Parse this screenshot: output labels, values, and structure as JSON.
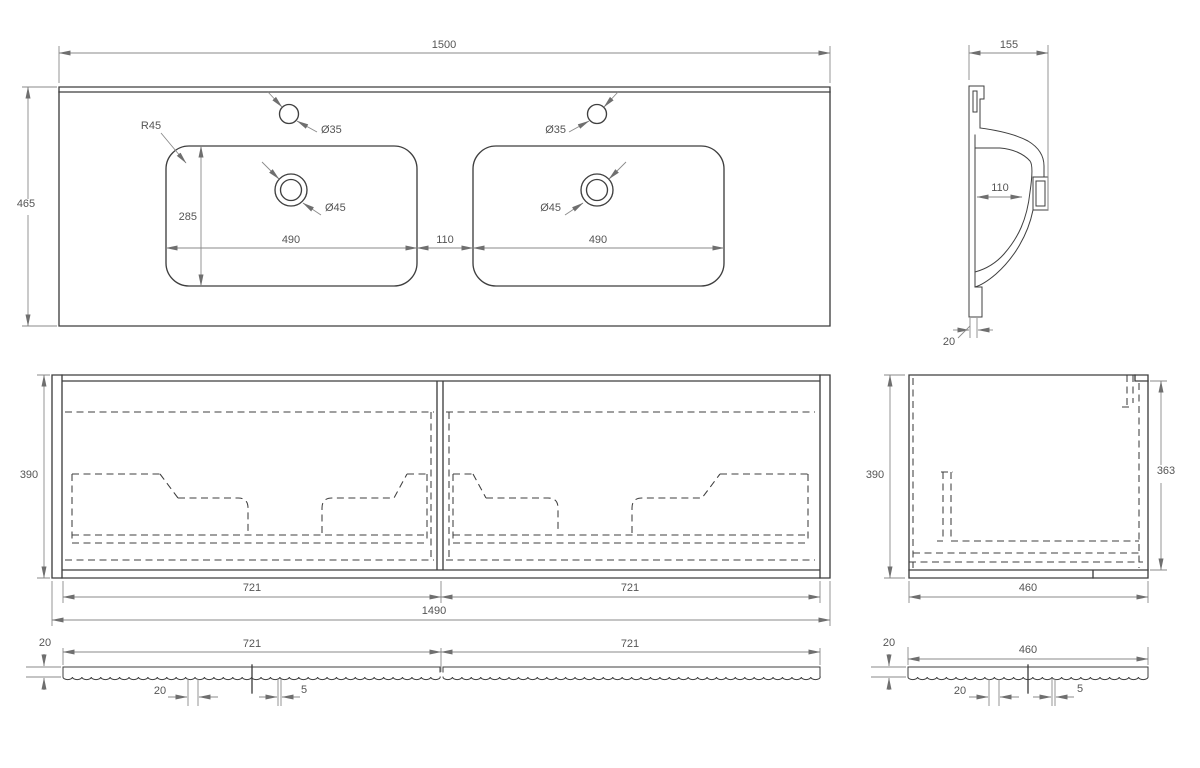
{
  "colors": {
    "background": "#ffffff",
    "outline": "#3f3f3f",
    "dimension": "#8a8a8a",
    "arrow": "#6f6f6f",
    "text": "#555555"
  },
  "views": {
    "countertop_plan": {
      "dims": {
        "width_total": "1500",
        "depth_total": "465",
        "corner_radius": "R45",
        "faucet_hole_left": "Ø35",
        "faucet_hole_right": "Ø35",
        "drain_left": "Ø45",
        "drain_right": "Ø45",
        "basin_width_left": "490",
        "basin_width_right": "490",
        "basin_spacing": "110",
        "basin_depth": "285"
      }
    },
    "basin_section": {
      "dims": {
        "profile_width": "155",
        "bowl_inner_width": "110",
        "flange_thickness": "20"
      }
    },
    "cabinet_front": {
      "dims": {
        "height": "390",
        "drawer_front_left": "721",
        "drawer_front_right": "721",
        "width_total": "1490"
      }
    },
    "cabinet_side": {
      "dims": {
        "height": "390",
        "interior_height": "363",
        "depth": "460"
      }
    },
    "drawer_fronts_top": {
      "dims": {
        "thickness": "20",
        "front_left": "721",
        "front_right": "721",
        "center_detail": "20",
        "gap": "5"
      }
    },
    "side_panel_top": {
      "dims": {
        "thickness": "20",
        "width": "460",
        "center_detail": "20",
        "gap": "5"
      }
    }
  }
}
